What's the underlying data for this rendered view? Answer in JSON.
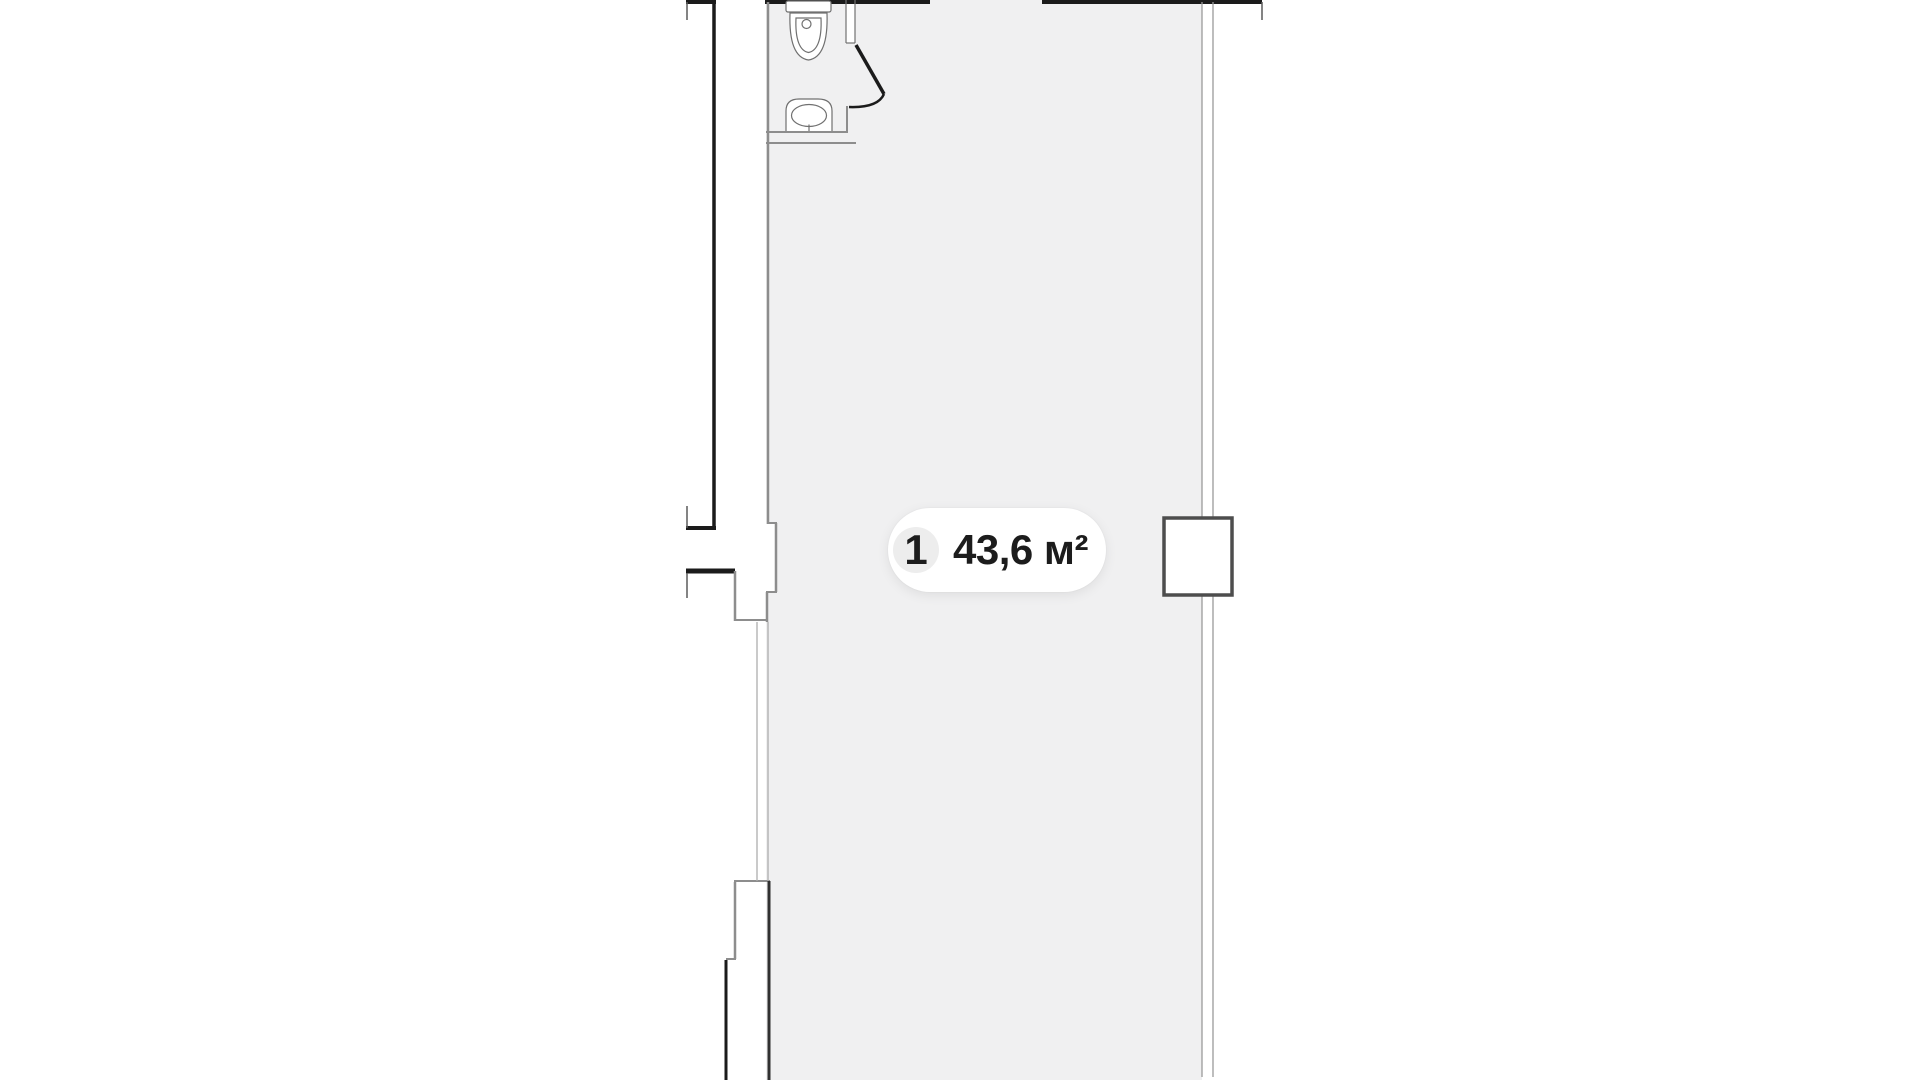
{
  "unit_badge": {
    "number": "1",
    "area": "43,6 м²"
  },
  "plan": {
    "type": "floor-plan",
    "unit_area_m2": "43,6",
    "unit_number": "1",
    "rooms": [
      "main-room",
      "bathroom"
    ],
    "fixtures": [
      "toilet-icon",
      "sink-icon",
      "door-swing-icon",
      "column-marker"
    ]
  },
  "colors": {
    "floor": "#f0f0f1",
    "wall_black": "#1b1b1b",
    "wall_gray": "#8d8d8d",
    "wall_light": "#adadad",
    "right_wall": "#9a9a9a",
    "edge_dark": "#303030",
    "tick": "#5a5a5a",
    "fixture": "#707070",
    "badge_bg": "#ffffff",
    "badge_circle": "#ededed",
    "badge_text": "#1c1c1c",
    "column": "#4d4d4d"
  }
}
